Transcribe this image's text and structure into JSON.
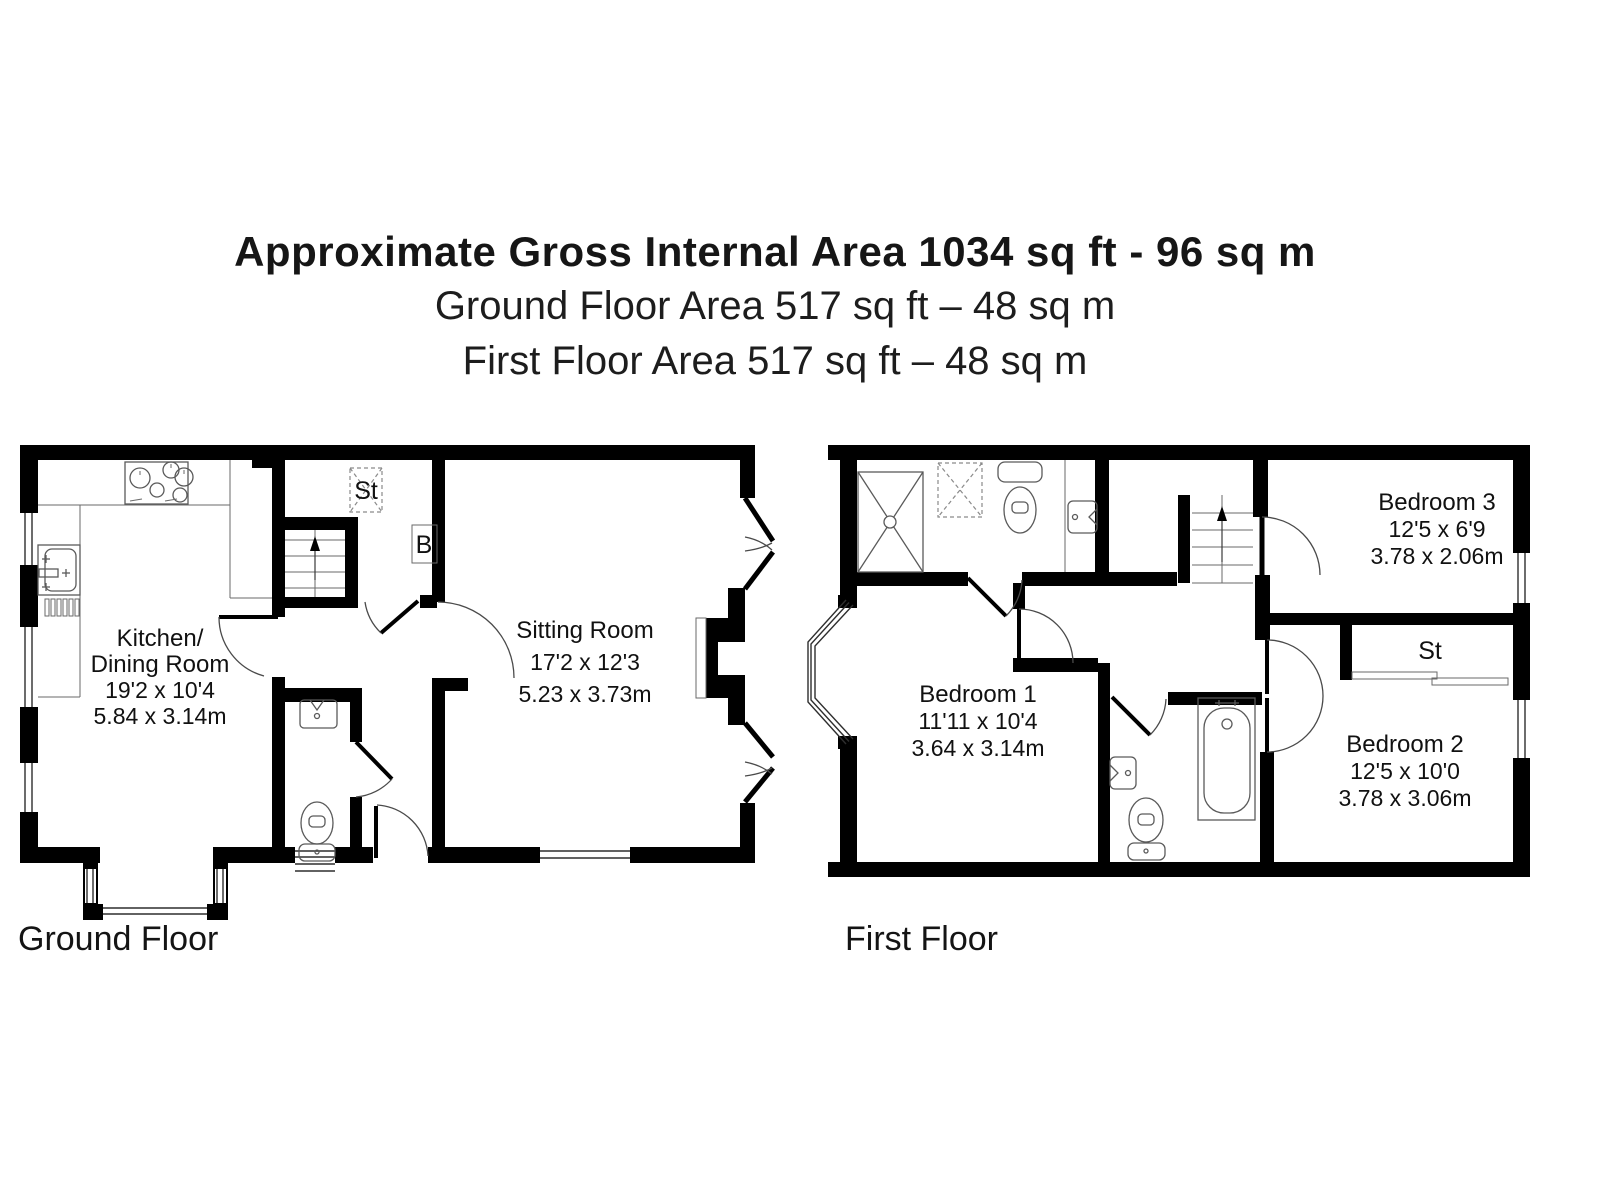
{
  "header": {
    "line1": "Approximate Gross Internal Area 1034 sq ft - 96 sq m",
    "line2": "Ground Floor Area 517 sq ft – 48 sq m",
    "line3": "First Floor Area 517 sq ft – 48 sq m"
  },
  "floors": {
    "ground": {
      "caption": "Ground Floor",
      "rooms": {
        "kitchen_dining": {
          "name_line1": "Kitchen/",
          "name_line2": "Dining Room",
          "dims_imperial": "19'2 x 10'4",
          "dims_metric": "5.84 x 3.14m"
        },
        "sitting_room": {
          "name": "Sitting Room",
          "dims_imperial": "17'2 x 12'3",
          "dims_metric": "5.23 x 3.73m"
        },
        "storage": {
          "label": "St"
        },
        "boiler": {
          "label": "B"
        }
      }
    },
    "first": {
      "caption": "First Floor",
      "rooms": {
        "bedroom1": {
          "name": "Bedroom 1",
          "dims_imperial": "11'11 x 10'4",
          "dims_metric": "3.64 x 3.14m"
        },
        "bedroom2": {
          "name": "Bedroom 2",
          "dims_imperial": "12'5 x 10'0",
          "dims_metric": "3.78 x 3.06m"
        },
        "bedroom3": {
          "name": "Bedroom 3",
          "dims_imperial": "12'5 x 6'9",
          "dims_metric": "3.78 x 2.06m"
        },
        "storage": {
          "label": "St"
        }
      }
    }
  },
  "colors": {
    "wall": "#000000",
    "fixture": "#5a5a5a",
    "text": "#111111",
    "background": "#ffffff"
  }
}
